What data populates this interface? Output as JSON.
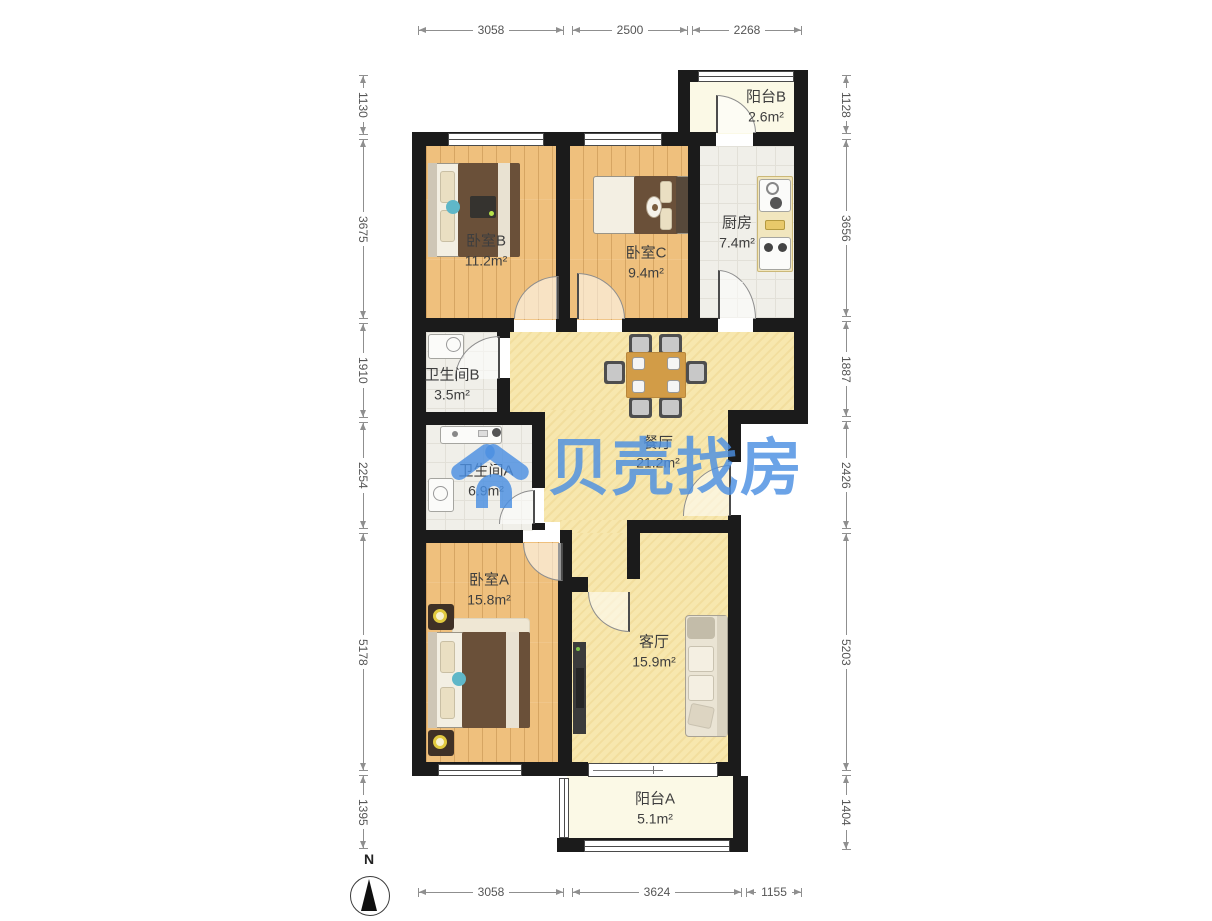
{
  "watermark": {
    "brand_text": "贝壳找房",
    "color": "#4a8fe2"
  },
  "compass": {
    "north_label": "N"
  },
  "rooms": {
    "balcony_b": {
      "name": "阳台B",
      "area": "2.6m²"
    },
    "kitchen": {
      "name": "厨房",
      "area": "7.4m²"
    },
    "bedroom_b": {
      "name": "卧室B",
      "area": "11.2m²"
    },
    "bedroom_c": {
      "name": "卧室C",
      "area": "9.4m²"
    },
    "bath_b": {
      "name": "卫生间B",
      "area": "3.5m²"
    },
    "bath_a": {
      "name": "卫生间A",
      "area": "6.9m²"
    },
    "dining": {
      "name": "餐厅",
      "area": "21.2m²"
    },
    "bedroom_a": {
      "name": "卧室A",
      "area": "15.8m²"
    },
    "living": {
      "name": "客厅",
      "area": "15.9m²"
    },
    "balcony_a": {
      "name": "阳台A",
      "area": "5.1m²"
    }
  },
  "dimensions": {
    "top": [
      "3058",
      "2500",
      "2268"
    ],
    "bottom": [
      "3058",
      "3624",
      "1155"
    ],
    "left": [
      "1130",
      "3675",
      "1910",
      "2254",
      "5178",
      "1395"
    ],
    "right": [
      "1128",
      "3656",
      "1887",
      "2426",
      "5203",
      "1404"
    ]
  },
  "colors": {
    "wall": "#1b1b1b",
    "wood_floor": "#efc07d",
    "hall_floor": "#f7e7ae",
    "tile_floor": "#f0efe9",
    "balcony_floor": "#fbf9e6",
    "watermark_blue": "#4a8fe2"
  }
}
